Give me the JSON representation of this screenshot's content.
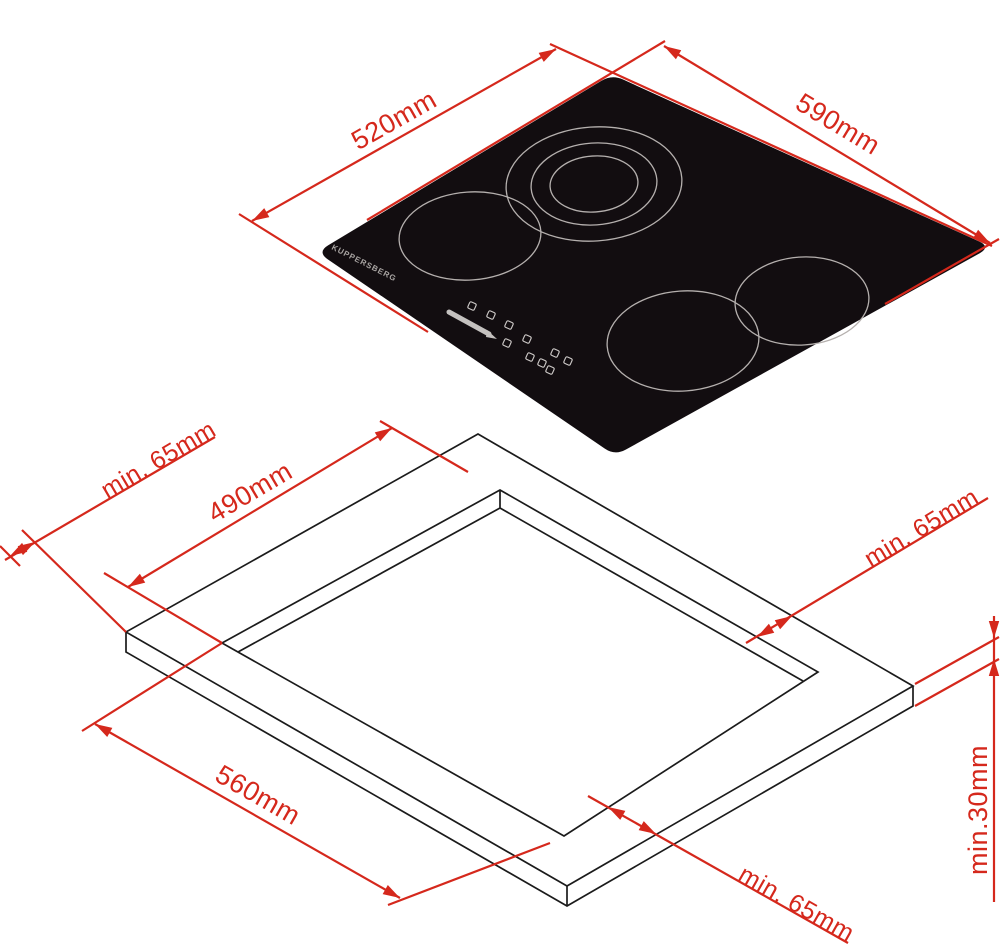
{
  "colors": {
    "dimension_red": "#d5281c",
    "outline_black": "#1b1b1b",
    "hob_glass_black": "#120d10",
    "burner_ring_gray": "#b5b0ae",
    "control_gray": "#cfcbc9"
  },
  "hob_view": {
    "brand_label": "KUPPERSBERG",
    "width_dim": "520mm",
    "depth_dim": "590mm",
    "burners": [
      "rear-center-triple-zone",
      "mid-left-single-zone",
      "mid-right-single-zone",
      "front-center-single-zone"
    ]
  },
  "cutout_view": {
    "cutout_width_dim": "490mm",
    "cutout_depth_dim": "560mm",
    "clearance_rear_left_dim": "min. 65mm",
    "clearance_right_dim": "min. 65mm",
    "clearance_front_dim": "min. 65mm",
    "worktop_thickness_dim": "min.30mm"
  }
}
